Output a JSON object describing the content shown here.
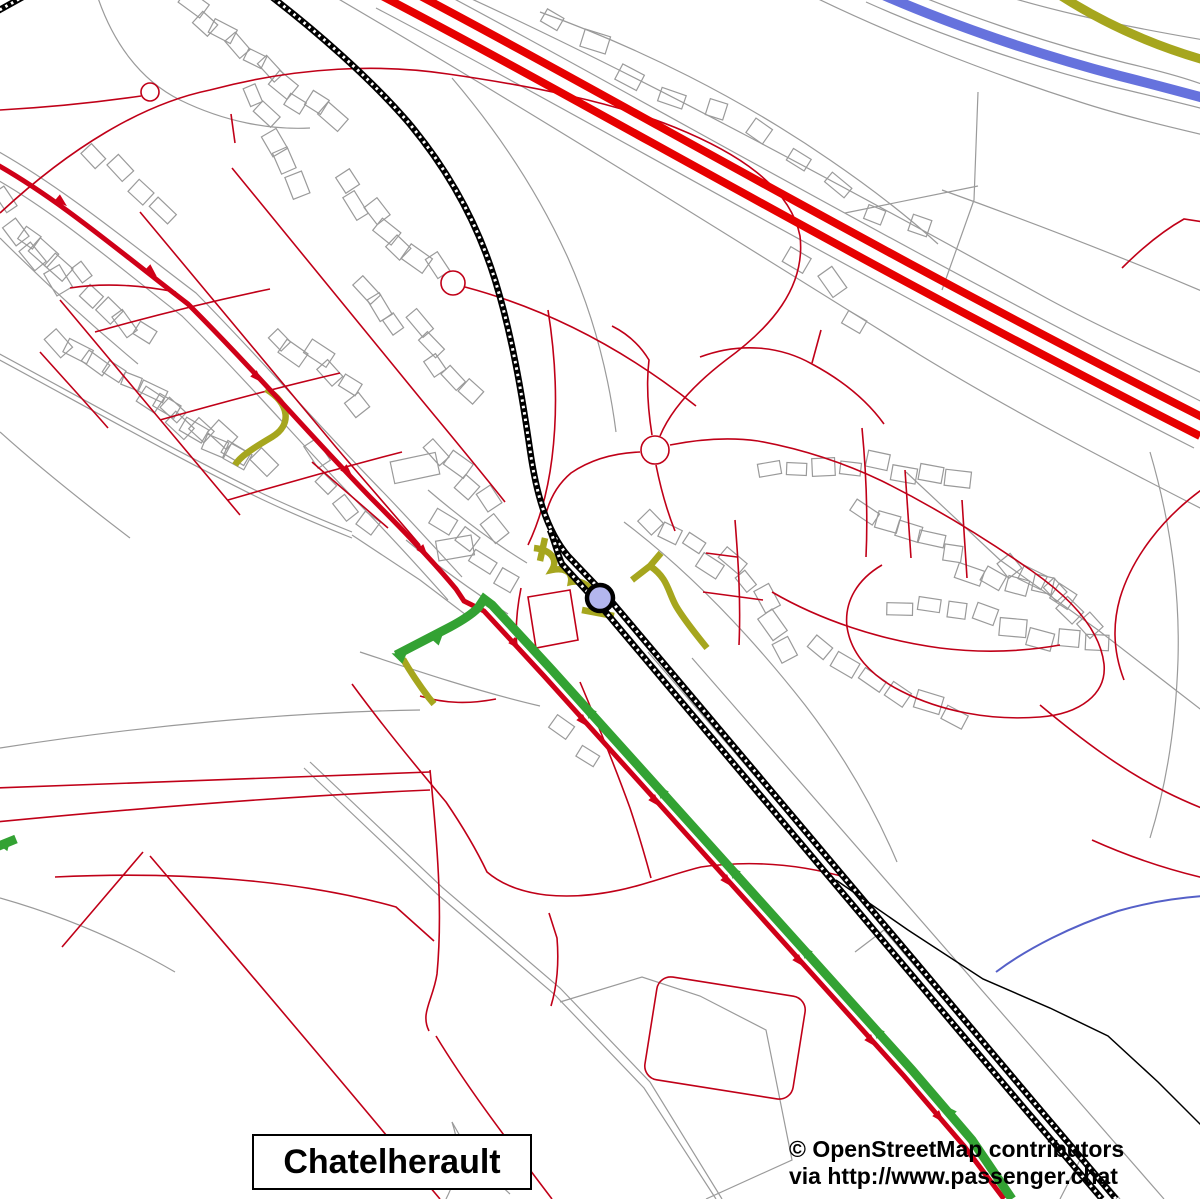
{
  "map": {
    "place_label": "Chatelherault",
    "attribution": {
      "line1": "© OpenStreetMap contributors",
      "line2": "via http://www.passenger.chat"
    },
    "marker": {
      "kind": "highlighted-station",
      "cx": 600,
      "cy": 598,
      "r": 13,
      "fill": "#b3b6ee",
      "stroke": "#000000",
      "stroke_width": 4.5
    },
    "colors": {
      "background": "#ffffff",
      "motorway": "#e60000",
      "route_red": "#cf0018",
      "minor_road": "#c00018",
      "route_green": "#33a233",
      "path_olive": "#a6a61e",
      "river_blue": "#6672dd",
      "stream_blue": "#5560c8",
      "railway": "#000000",
      "detail_gray": "#9a9a9a",
      "label_text": "#000000",
      "label_bg": "#ffffff"
    }
  }
}
